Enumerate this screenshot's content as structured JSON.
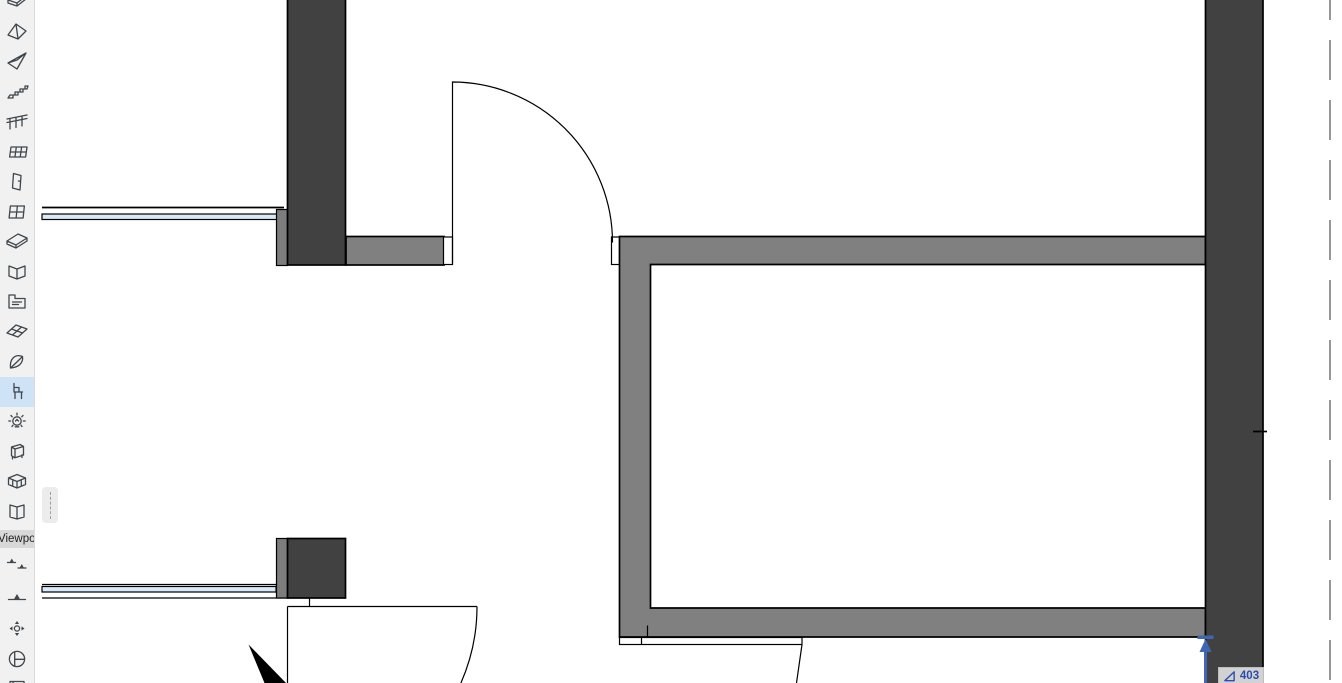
{
  "app": {
    "view": "floor-plan-canvas"
  },
  "toolbar": {
    "group_label": "Viewpoi",
    "selected_tool": "object-chair",
    "tools": [
      {
        "icon": "slab-icon"
      },
      {
        "icon": "roof-icon"
      },
      {
        "icon": "shell-icon"
      },
      {
        "icon": "stair-icon"
      },
      {
        "icon": "railing-icon"
      },
      {
        "icon": "curtain-wall-icon"
      },
      {
        "icon": "door-icon"
      },
      {
        "icon": "window-icon"
      },
      {
        "icon": "skylight-icon"
      },
      {
        "icon": "corner-window-icon"
      },
      {
        "icon": "zone-icon"
      },
      {
        "icon": "mesh-icon"
      },
      {
        "icon": "morph-icon"
      },
      {
        "icon": "object-chair-icon"
      },
      {
        "icon": "lamp-icon"
      },
      {
        "icon": "equipment-icon"
      },
      {
        "icon": "grid-element-icon"
      },
      {
        "icon": "sheet-icon"
      },
      {
        "icon": "section-icon"
      },
      {
        "icon": "elevation-icon"
      },
      {
        "icon": "orbit-icon"
      },
      {
        "icon": "detail-icon"
      },
      {
        "icon": "worksheet-icon"
      }
    ]
  },
  "tracker": {
    "value": "403",
    "icon": "angle-icon"
  },
  "colors": {
    "wall_dark": "#414141",
    "wall_gray": "#808080",
    "pier_strip": "#7d7d7d",
    "glazing": "#d9e9f8",
    "accent_blue": "#4066b2",
    "tracker_text": "#2b4db0",
    "toolbar_bg": "#f1f1f1",
    "selection_bg": "#cfe3f7",
    "badge_bg": "#d2d2d2"
  }
}
